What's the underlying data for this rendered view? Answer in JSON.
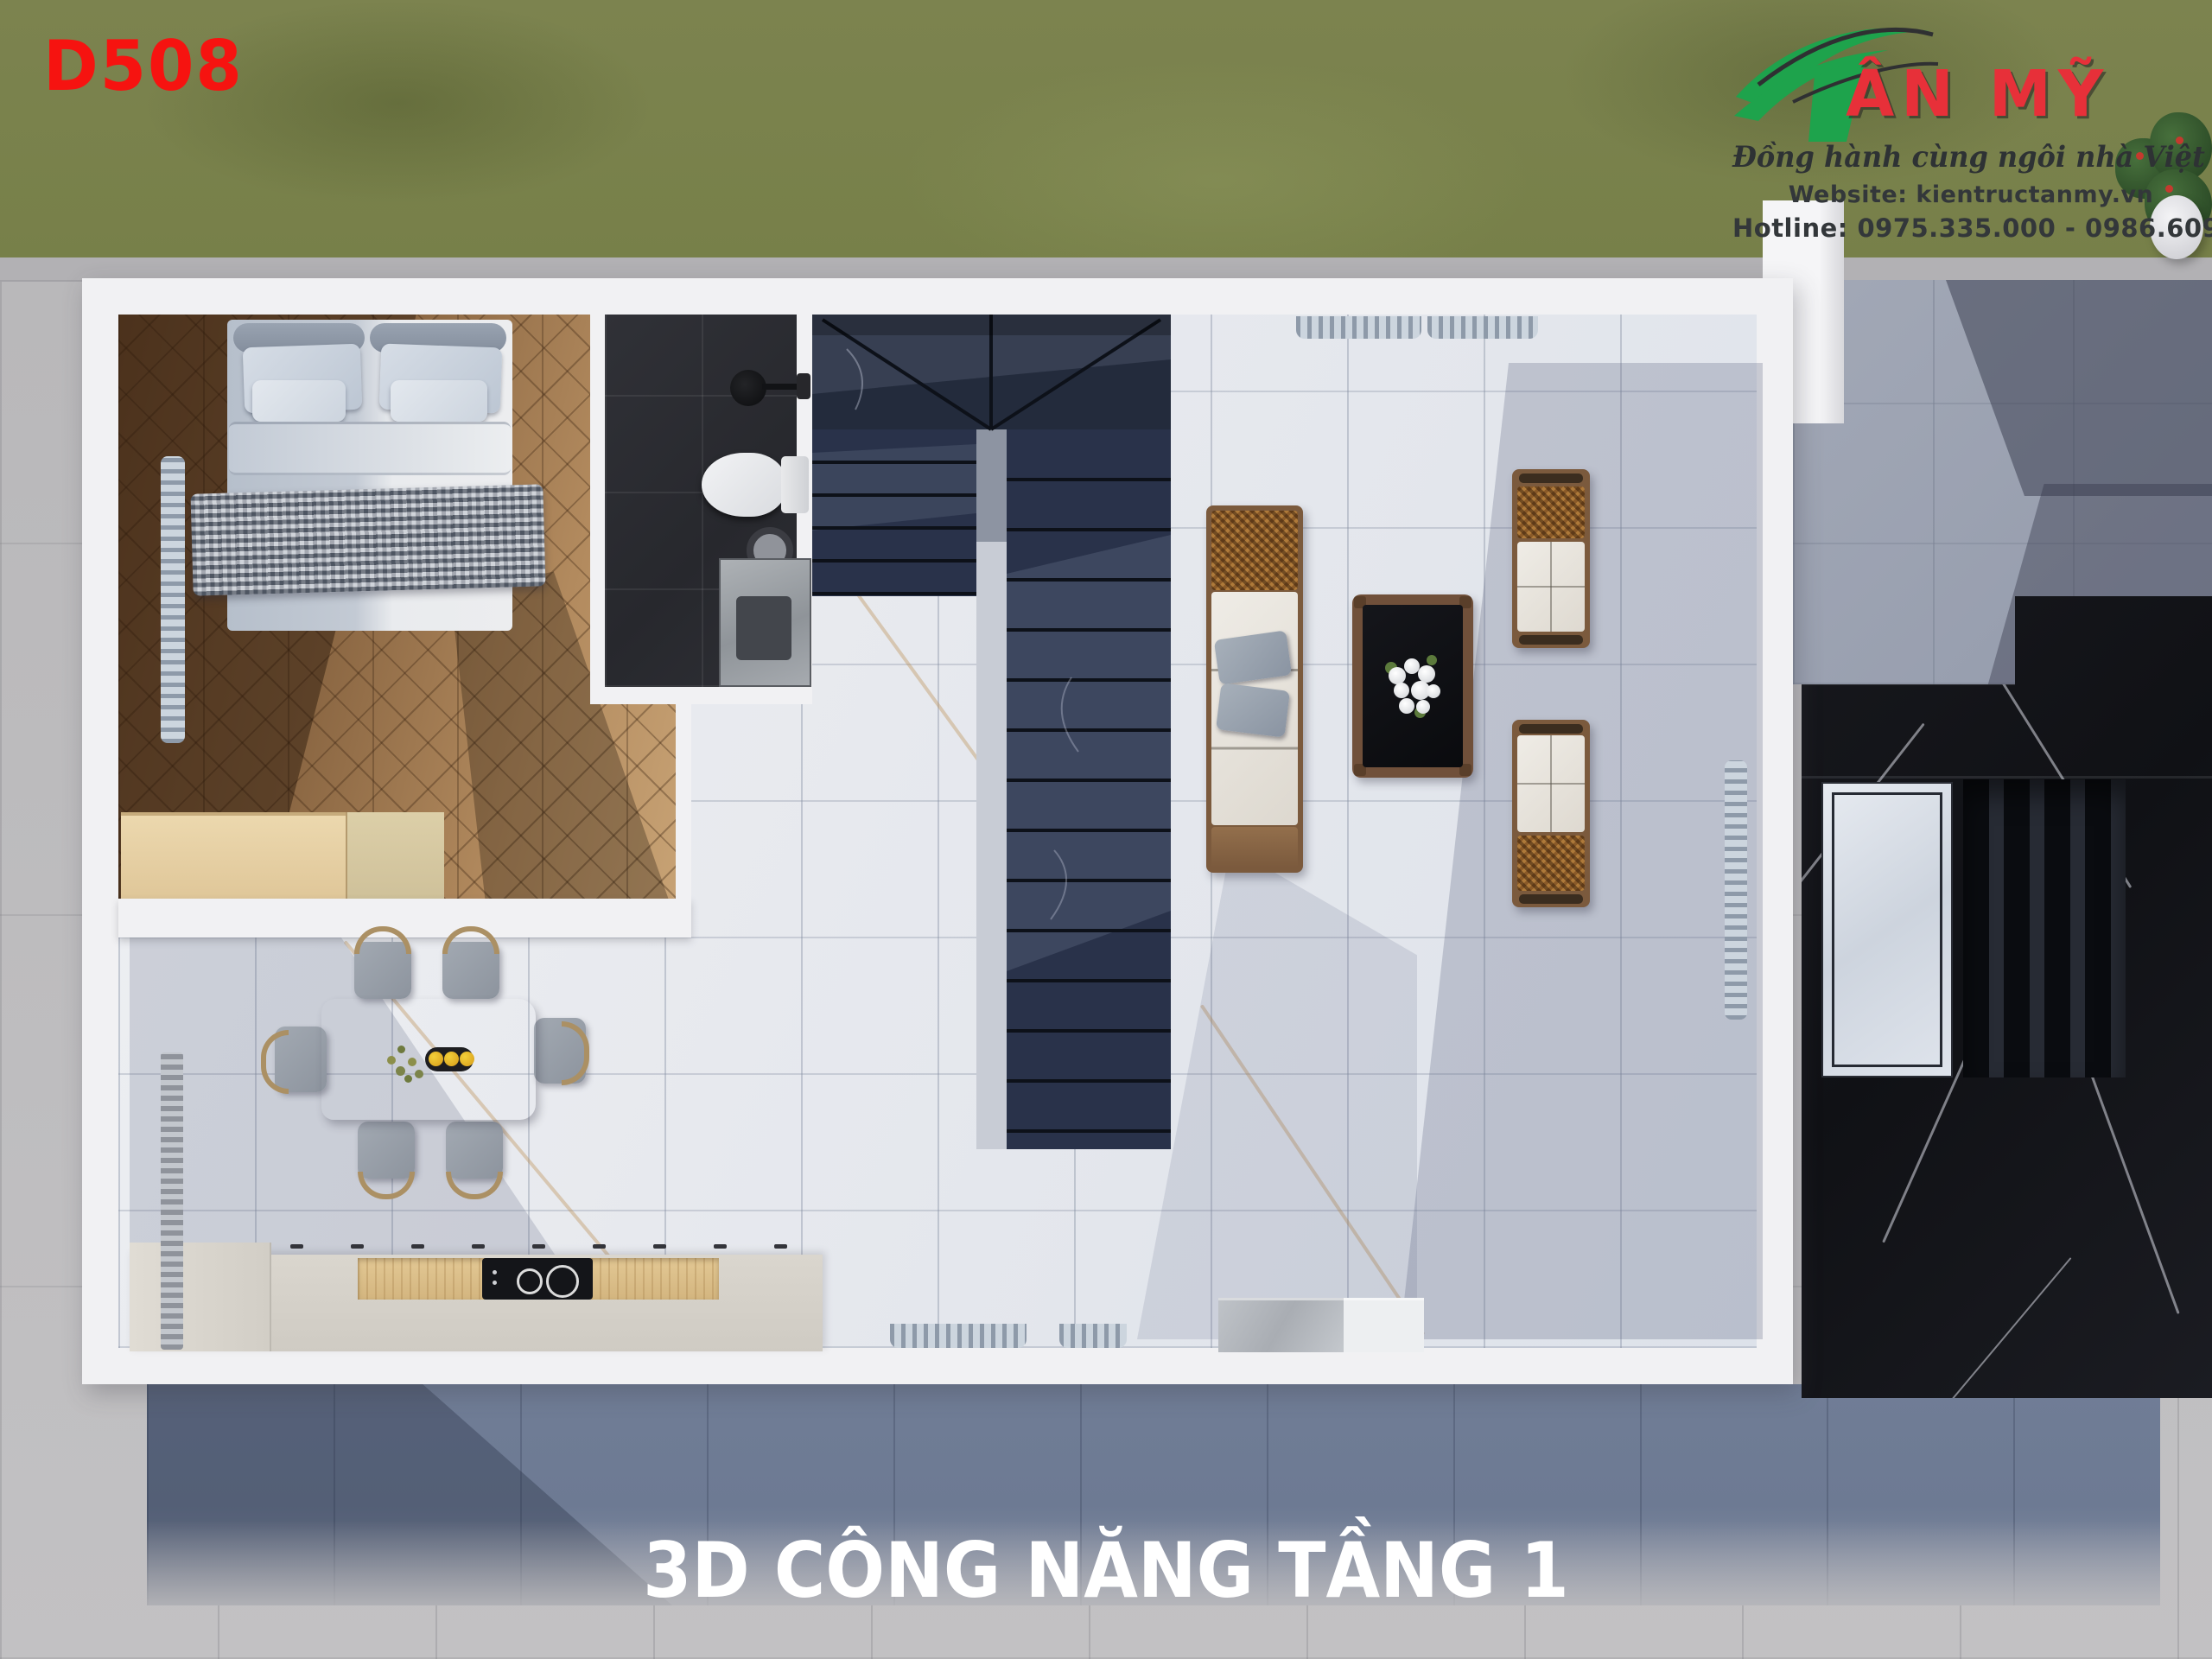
{
  "header": {
    "plan_code": "D508"
  },
  "footer": {
    "title": "3D CÔNG NĂNG TẦNG 1"
  },
  "branding": {
    "brand_rest": "ÂN MỸ",
    "tagline": "Đồng hành cùng ngôi nhà Việt",
    "website_label": "Website:",
    "website_value": "kientructanmy.vn",
    "hotline_label": "Hotline:",
    "hotline_value": "0975.335.000 - 0986.609.259"
  },
  "colors": {
    "accent_red": "#f61310",
    "logo_green": "#1ea34c",
    "logo_text_red": "#e73039",
    "title_white": "#ffffff",
    "grass": "#79814e",
    "pavement": "#bcbcbe",
    "patio_slate": "#6d7a93",
    "wall_white": "#f1f1f3",
    "wood_floor": "#9a734c",
    "living_floor": "#e9ebee",
    "bath_tile": "#2c2d32",
    "stair_marble": "#273043",
    "slab_marble": "#15161a",
    "counter": "#d7d3cb",
    "table_wood": "#bb9d7c"
  }
}
